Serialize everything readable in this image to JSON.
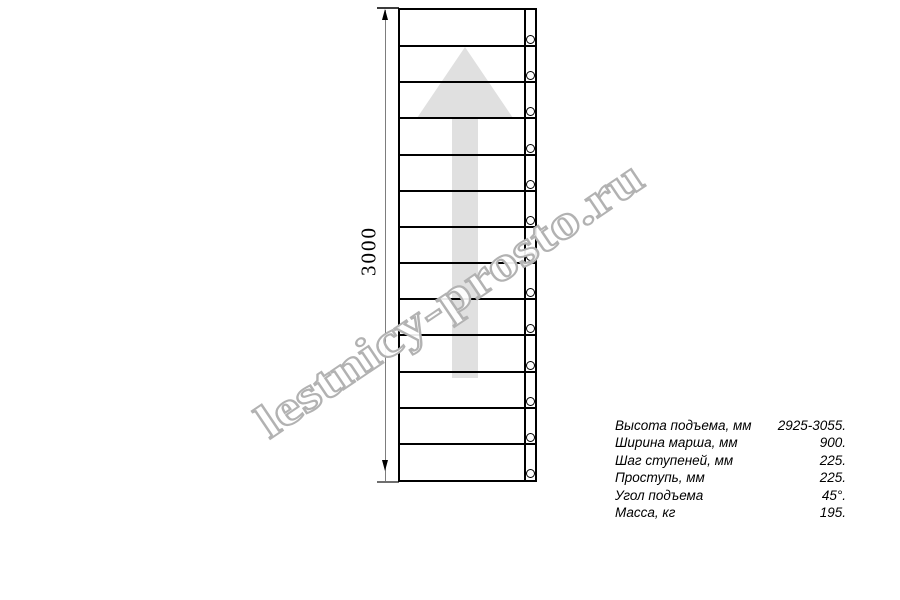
{
  "page": {
    "background": "#ffffff"
  },
  "watermark": {
    "text": "lestnicy-prosto.ru",
    "color": "#b2b2b2"
  },
  "drawing": {
    "type": "straight-staircase-plan-view",
    "treads": 13,
    "line_color": "#000000",
    "dimension": {
      "label": "3000"
    },
    "arrow": {
      "direction": "up",
      "fill": "#e0e0e0"
    }
  },
  "specs": {
    "rows": [
      {
        "label": "Высота подъема, мм",
        "value": "2925-3055."
      },
      {
        "label": "Ширина марша, мм",
        "value": "900."
      },
      {
        "label": "Шаг ступеней, мм",
        "value": "225."
      },
      {
        "label": "Проступь, мм",
        "value": "225."
      },
      {
        "label": "Угол подъема",
        "value": "45°."
      },
      {
        "label": "Масса, кг",
        "value": "195."
      }
    ]
  }
}
